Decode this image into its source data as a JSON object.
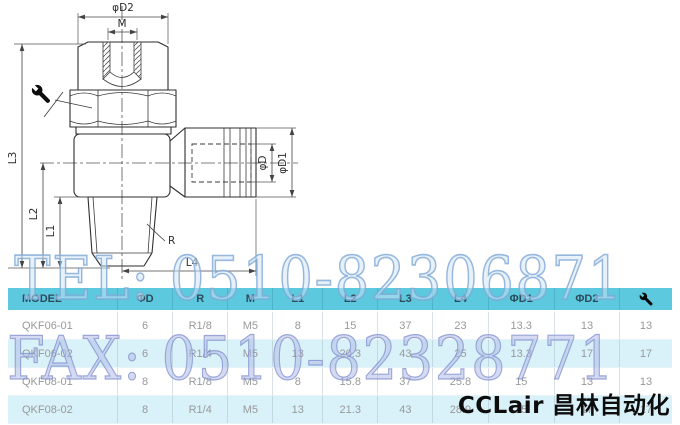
{
  "drawing": {
    "dim_labels": {
      "d2": "φD2",
      "m": "M",
      "l3": "L3",
      "l2": "L2",
      "l1": "L1",
      "l4": "L4",
      "r": "R",
      "d": "φD",
      "d1": "φD1"
    },
    "callout_icon": "wrench-icon"
  },
  "watermarks": {
    "tel": "TEL: 0510-82306871",
    "fax": "FAX: 0510-82328771",
    "logo": "CCLair 昌林自动化"
  },
  "table": {
    "columns": [
      "MODEL",
      "ΦD",
      "R",
      "M",
      "L1",
      "L2",
      "L3",
      "L4",
      "ΦD1",
      "ΦD2"
    ],
    "last_column_icon": "wrench-icon",
    "rows": [
      [
        "QKF06-01",
        "6",
        "R1/8",
        "M5",
        "8",
        "15",
        "37",
        "23",
        "13.3",
        "13",
        "13"
      ],
      [
        "QKF06-02",
        "6",
        "R1/4",
        "M5",
        "13",
        "20.3",
        "43",
        "25",
        "13.3",
        "17",
        "17"
      ],
      [
        "QKF08-01",
        "8",
        "R1/8",
        "M5",
        "8",
        "15.8",
        "37",
        "25.8",
        "15",
        "13",
        "13"
      ],
      [
        "QKF08-02",
        "8",
        "R1/4",
        "M5",
        "13",
        "21.3",
        "43",
        "28.9",
        "15",
        "17",
        "17"
      ]
    ],
    "colors": {
      "header_bg": "#5cc9de",
      "header_text": "#2d4a5a",
      "row_alt_bg": "#d9f1f8",
      "cell_text": "#98999b"
    }
  },
  "watermark_colors": {
    "tel_blue": "#9cc0e4",
    "fax_periwinkle": "#aab4e0",
    "logo_black": "#0d0d0d"
  }
}
